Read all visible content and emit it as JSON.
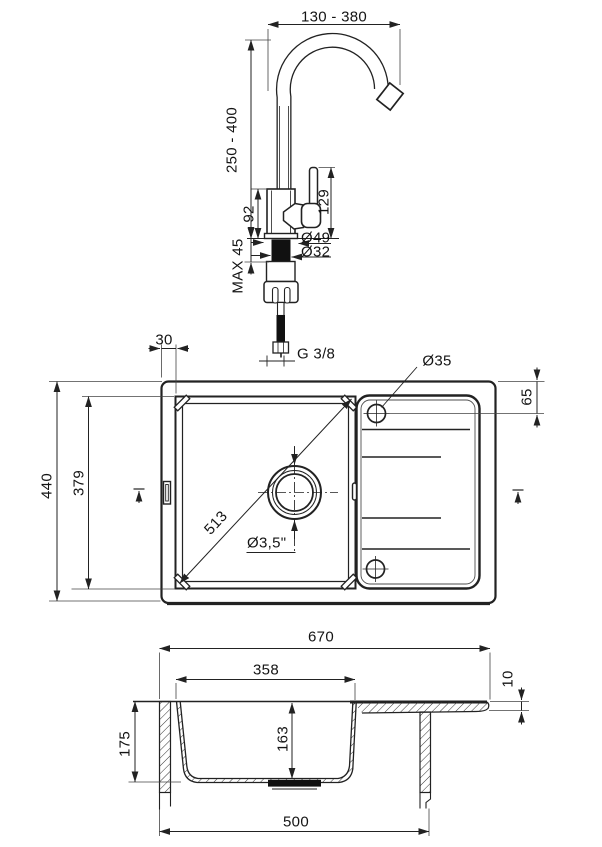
{
  "faucet": {
    "spout_reach_range": "130 - 380",
    "height_range": "250 - 400",
    "body_height": "92",
    "lever_height": "129",
    "base_diameter": "Ø49",
    "shank_diameter": "Ø32",
    "max_mounting_thickness": "MAX 45",
    "connection_thread": "G 3/8"
  },
  "top_view": {
    "rim_to_bowl_offset": "30",
    "overall_depth": "440",
    "bowl_length": "379",
    "bowl_diagonal": "513",
    "drain_diameter": "Ø3,5\"",
    "tap_hole_diameter": "Ø35",
    "tap_hole_offset": "65"
  },
  "section_view": {
    "overall_width": "670",
    "bowl_width": "358",
    "rim_thickness": "10",
    "overall_height": "175",
    "bowl_depth": "163",
    "cabinet_width": "500"
  },
  "colors": {
    "line": "#222222",
    "background": "#ffffff"
  }
}
